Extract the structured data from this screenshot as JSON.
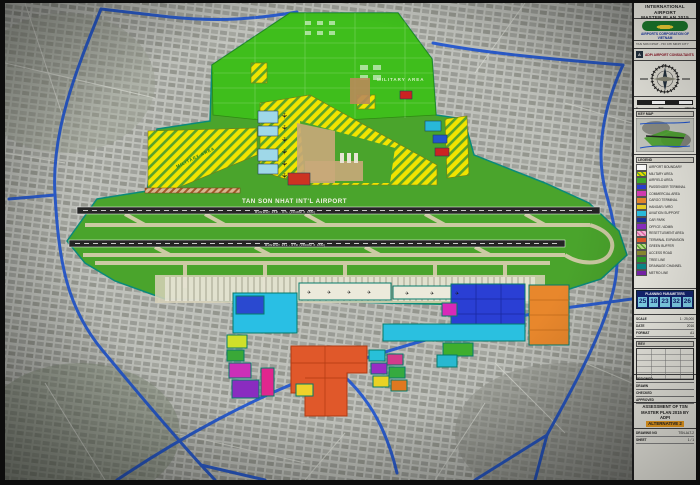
{
  "map": {
    "airport_label": "TAN SON NHAT INT'L AIRPORT",
    "runway_north_label": "RUNWAY 25R - 07L  (3048M X 45M)",
    "runway_south_label": "RUNWAY 25L - 07R  (3800M X 45M)",
    "military_area_top_label": "MILITARY AREA",
    "military_area_west_label": "MILITARY AREA"
  },
  "panel": {
    "title1": "INTERNATIONAL AIRPORT",
    "title2": "MASTER PLAN 2015",
    "org": "AIRPORTS CORPORATION OF VIETNAM",
    "org_sub": "TAN SON NHAT - HO CHI MINH CITY",
    "consultant_mark": "A",
    "consultant": "ADPi AIRPORT CONSULTANTS",
    "compass_n": "N",
    "scale_zero": "0",
    "scale_mid": "500",
    "scale_end": "1000 M",
    "keymap_title": "KEY MAP",
    "legend_title": "LEGEND",
    "legend": [
      {
        "label": "AIRPORT BOUNDARY",
        "swatch": "#ffffff"
      },
      {
        "label": "MILITARY AREA",
        "swatch": "repeating-linear-gradient(45deg,#f2e400 0 2px,#5aa32a 2px 3.5px)"
      },
      {
        "label": "AIRFIELD AREA",
        "swatch": "#3fae2a"
      },
      {
        "label": "PASSENGER TERMINAL",
        "swatch": "#2a3fd4"
      },
      {
        "label": "COMMERCIAL AREA",
        "swatch": "#d63bb4"
      },
      {
        "label": "CARGO TERMINAL",
        "swatch": "#e8872c"
      },
      {
        "label": "HANGAR / MRO",
        "swatch": "#ead224"
      },
      {
        "label": "AVIATION SUPPORT",
        "swatch": "#2ac0e0"
      },
      {
        "label": "CAR PARK",
        "swatch": "#1a2f9e"
      },
      {
        "label": "OFFICE / ADMIN",
        "swatch": "#8a2cc0"
      },
      {
        "label": "RESETTLEMENT AREA",
        "swatch": "repeating-linear-gradient(45deg,#f8b8d8 0 2px,#e066a8 2px 3.5px)"
      },
      {
        "label": "TERMINAL EXPANSION",
        "swatch": "#e0582a"
      },
      {
        "label": "GREEN BUFFER",
        "swatch": "repeating-linear-gradient(45deg,#bfe08a 0 2px,#57a32a 2px 3.5px)"
      },
      {
        "label": "ACCESS ROAD",
        "swatch": "#8a8a30"
      },
      {
        "label": "TREE LINE",
        "swatch": "#2a9a2a"
      },
      {
        "label": "DRAINAGE CHANNEL",
        "swatch": "#0a8a8a"
      },
      {
        "label": "METRO LINE",
        "swatch": "#7722aa"
      }
    ],
    "table_title": "PLANNING PARAMETERS",
    "table_cells": [
      {
        "v": "25"
      },
      {
        "v": "18"
      },
      {
        "v": "23"
      },
      {
        "v": "32"
      },
      {
        "v": "26"
      }
    ],
    "info_rows": [
      {
        "k": "SCALE",
        "v": "1 : 25,000"
      },
      {
        "k": "DATE",
        "v": "2016"
      },
      {
        "k": "FORMAT",
        "v": "A1"
      }
    ],
    "rev_title": "REV",
    "sign_rows": [
      {
        "label": "DESIGNED"
      },
      {
        "label": "DRAWN"
      },
      {
        "label": "CHECKED"
      },
      {
        "label": "APPROVED"
      }
    ],
    "assess1": "ASSESSMENT OF TSN",
    "assess2": "MASTER PLAN 2015 BY ADPI",
    "assess_alt": "ALTERNATIVE 2",
    "bottom_rows": [
      {
        "k": "DRAWING NO",
        "v": "TSN-ALT-2"
      },
      {
        "k": "SHEET",
        "v": "1 / 1"
      }
    ]
  }
}
